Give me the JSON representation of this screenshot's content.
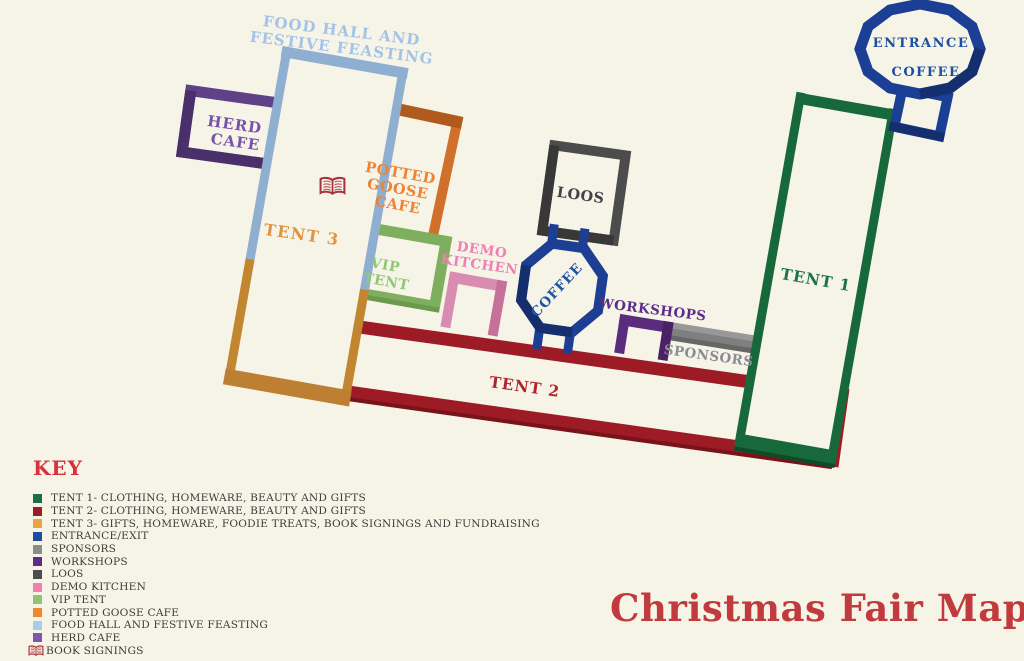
{
  "title": "Christmas Fair Map",
  "key": {
    "heading": "KEY",
    "items": [
      {
        "label": "TENT 1- CLOTHING, HOMEWARE, BEAUTY AND GIFTS",
        "swatch": "#1a6f44",
        "type": "square"
      },
      {
        "label": "TENT 2- CLOTHING, HOMEWARE, BEAUTY AND GIFTS",
        "swatch": "#9c1b25",
        "type": "square"
      },
      {
        "label": "TENT 3- GIFTS, HOMEWARE, FOODIE TREATS, BOOK SIGNINGS AND FUNDRAISING",
        "swatch": "#eca43e",
        "type": "square"
      },
      {
        "label": "ENTRANCE/EXIT",
        "swatch": "#1c4da0",
        "type": "square"
      },
      {
        "label": "SPONSORS",
        "swatch": "#8c8c8c",
        "type": "square"
      },
      {
        "label": "WORKSHOPS",
        "swatch": "#5b2d86",
        "type": "square"
      },
      {
        "label": "LOOS",
        "swatch": "#4c4c4c",
        "type": "square"
      },
      {
        "label": "DEMO KITCHEN",
        "swatch": "#f07fb2",
        "type": "square"
      },
      {
        "label": "VIP TENT",
        "swatch": "#93c276",
        "type": "square"
      },
      {
        "label": "POTTED GOOSE CAFE",
        "swatch": "#ec8a31",
        "type": "square"
      },
      {
        "label": "FOOD HALL AND FESTIVE FEASTING",
        "swatch": "#aacbea",
        "type": "square"
      },
      {
        "label": "HERD CAFE",
        "swatch": "#7e57a8",
        "type": "square"
      },
      {
        "label": "BOOK SIGNINGS",
        "swatch": "#a8323e",
        "type": "book"
      }
    ]
  },
  "map": {
    "labels": {
      "food_hall": [
        "FOOD HALL AND",
        "FESTIVE FEASTING"
      ],
      "herd_cafe": [
        "HERD",
        "CAFE"
      ],
      "tent3": "TENT 3",
      "potted_goose": [
        "POTTED",
        "GOOSE",
        "CAFE"
      ],
      "vip_tent": [
        "VIP",
        "TENT"
      ],
      "demo_kitchen": [
        "DEMO",
        "KITCHEN"
      ],
      "tent2": "TENT 2",
      "loos": "LOOS",
      "coffee": "COFFEE",
      "workshops": "WORKSHOPS",
      "sponsors": "SPONSORS",
      "tent1": "TENT 1",
      "entrance": [
        "ENTRANCE",
        "COFFEE"
      ]
    },
    "colors": {
      "tent1": "#17693c",
      "tent2": "#9c1b25",
      "tent3_tan": "#bd8032",
      "food_hall_blue": "#8fafd0",
      "herd_purple": "#5e4187",
      "potted_orange": "#d0702a",
      "vip_green": "#7fae5e",
      "demo_pink": "#d98cb2",
      "loos_gray": "#4c4c4c",
      "coffee_blue": "#1c3f94",
      "workshops_purple": "#5b2b7e",
      "sponsors_gray": "#7f7f7f",
      "background": "#f6f3e7"
    }
  }
}
